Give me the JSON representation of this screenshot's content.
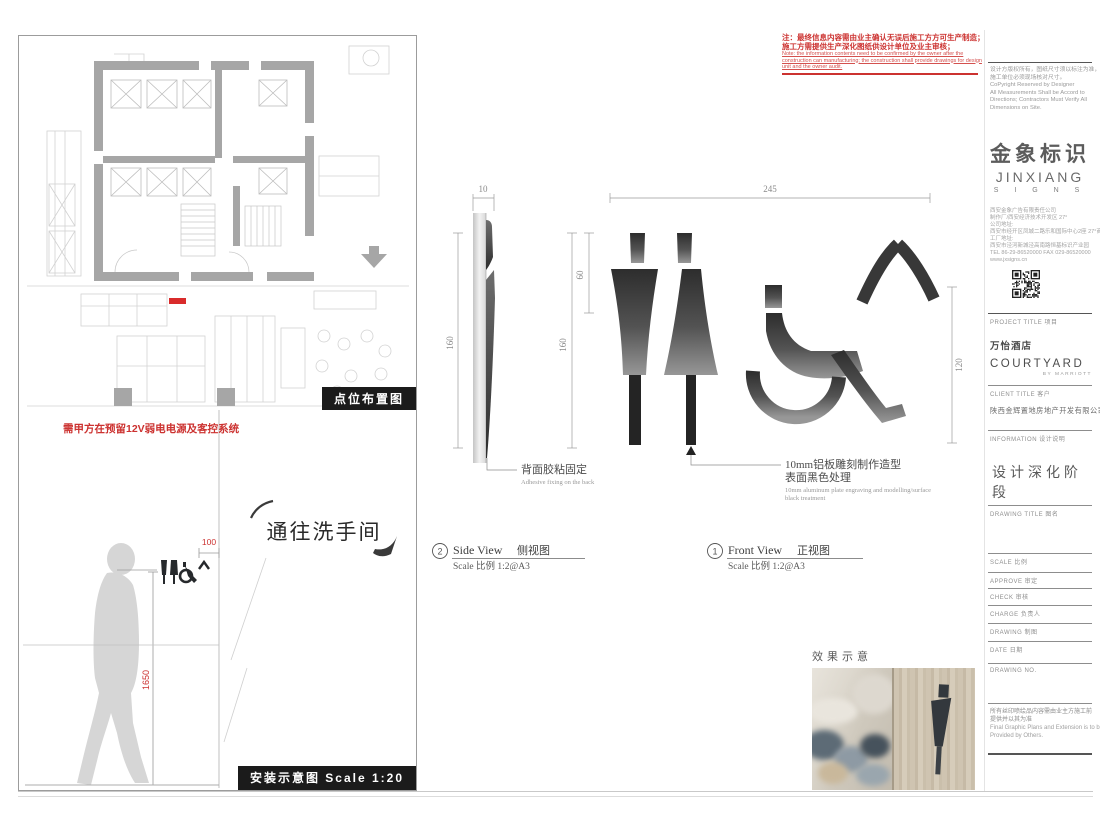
{
  "warning": {
    "line1": "注：最终信息内容需由业主确认无误后施工方方可生产制造；",
    "line2": "施工方需提供生产深化图纸供设计单位及业主审核；",
    "en1": "Note: the information contents need to be confirmed by the owner after the",
    "en2": "construction can manufacturing; the construction shall provide drawings for design",
    "en3": "unit and the owner audit."
  },
  "plan": {
    "label": "点位布置图"
  },
  "install": {
    "note": "需甲方在预留12V弱电电源及客控系统",
    "sign_text": "通往洗手间",
    "dim_100": "100",
    "dim_1650": "1650",
    "label": "安装示意图  Scale 1:20"
  },
  "side_view": {
    "num": "2",
    "title_en": "Side View",
    "title_cn": "侧视图",
    "scale": "Scale 比例 1:2@A3",
    "dim_10": "10",
    "dim_160_left": "160",
    "dim_60": "60",
    "dim_160_right": "160",
    "callout_cn": "背面胶粘固定",
    "callout_en": "Adhesive fixing on the back"
  },
  "front_view": {
    "num": "1",
    "title_en": "Front View",
    "title_cn": "正视图",
    "scale": "Scale 比例 1:2@A3",
    "dim_245": "245",
    "dim_120": "120",
    "callout_cn1": "10mm铝板雕刻制作造型",
    "callout_cn2": "表面黑色处理",
    "callout_en1": "10mm aluminum plate engraving and modelling/surface",
    "callout_en2": "black treatment"
  },
  "effect": {
    "label": "效果示意"
  },
  "titleblock": {
    "copyright_cn1": "设计方版权所有，图纸尺寸须以标注为准，",
    "copyright_cn2": "施工单位必须现场核对尺寸。",
    "copyright_en1": "CoPyright Reserved by Designer",
    "copyright_en2": "All Measurements Shall be Accord to",
    "copyright_en3": "Directions; Contractors Must Verify All",
    "copyright_en4": "Dimensions on Site.",
    "logo_cn": "金象标识",
    "logo_en": "JINXIANG",
    "logo_sub": "S I G N S",
    "company_lines": [
      "西安金象广告有限责任公司",
      "制作厂/西安经济技术开发区 27°",
      "公司地址:",
      "西安市经开区凤城二路乐和国际中心2座 27°商铺",
      "工厂地址:",
      "西安市泾河新城泾高南路恒基标识产业园",
      "TEL 86-29-86520000  FAX 029-86520000",
      "www.jxsigns.cn"
    ],
    "project_label": "PROJECT TITLE 项目",
    "project_cn": "万怡酒店",
    "project_en": "COURTYARD",
    "project_sub": "BY MARRIOTT",
    "client_label": "CLIENT TITLE 客户",
    "client_name": "陕西金辉置地房地产开发有限公司",
    "info_label": "INFORMATION 设计说明",
    "phase": "设计深化阶段",
    "drawing_title_label": "DRAWING TITLE 图名",
    "scale_label": "SCALE 比例",
    "approve_label": "APPROVE 审定",
    "check_label": "CHECK 审核",
    "charge_label": "CHARGE 负责人",
    "drawing_label": "DRAWING 制图",
    "date_label": "DATE 日期",
    "drawing_no_label": "DRAWING NO.",
    "note_cn1": "所有丝印喷绘品内容需由业主方施工前",
    "note_cn2": "提供并以其为准",
    "note_en1": "Final Graphic Plans and Extension is to be",
    "note_en2": "Provided by Others."
  }
}
